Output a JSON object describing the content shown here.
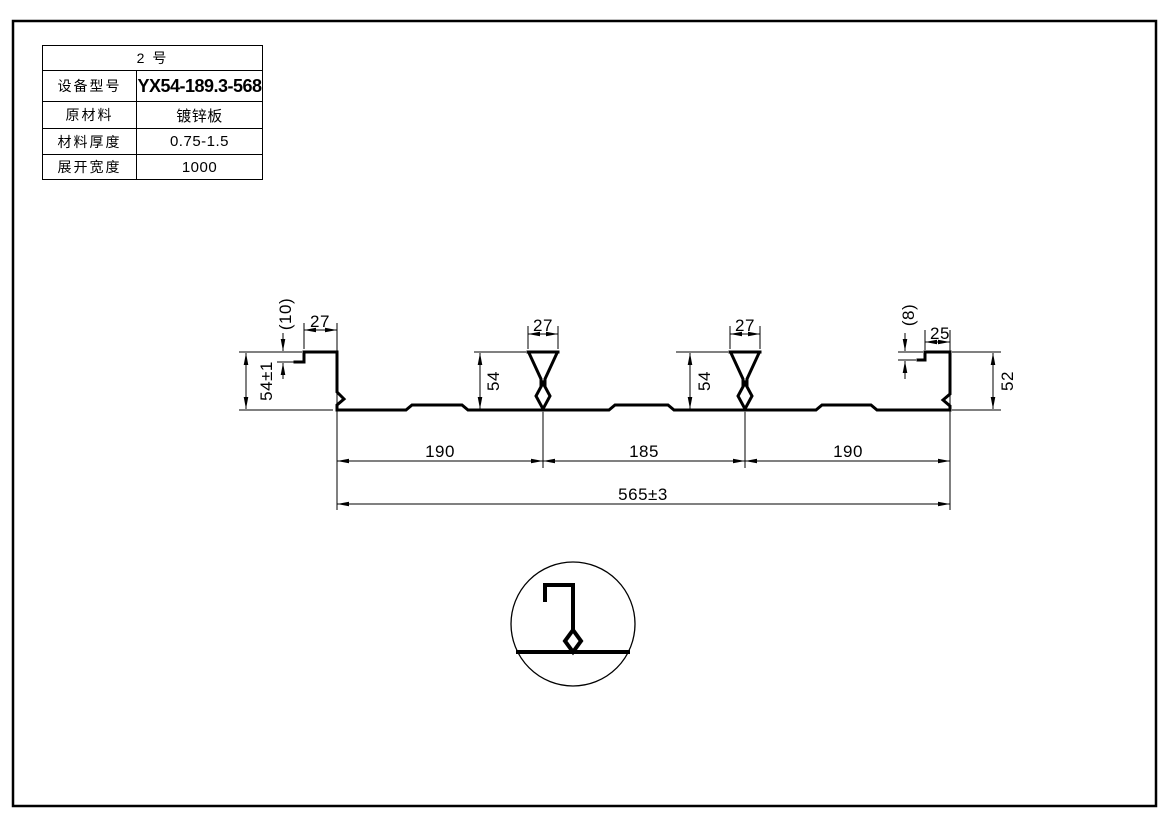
{
  "page": {
    "background": "#ffffff",
    "line_color": "#000000"
  },
  "title_block": {
    "machine_no": "2  号",
    "rows": [
      {
        "label": "设备型号",
        "value": "YX54-189.3-568"
      },
      {
        "label": "原材料",
        "value": "镀锌板"
      },
      {
        "label": "材料厚度",
        "value": "0.75-1.5"
      },
      {
        "label": "展开宽度",
        "value": "1000"
      }
    ]
  },
  "dims": {
    "left_lip": "(10)",
    "left_top": "27",
    "left_height": "54±1",
    "rib1_top": "27",
    "rib1_height": "54",
    "rib2_top": "27",
    "rib2_height": "54",
    "right_lip": "(8)",
    "right_top": "25",
    "right_height": "52",
    "span_left": "190",
    "span_mid": "185",
    "span_right": "190",
    "total": "565±3"
  }
}
